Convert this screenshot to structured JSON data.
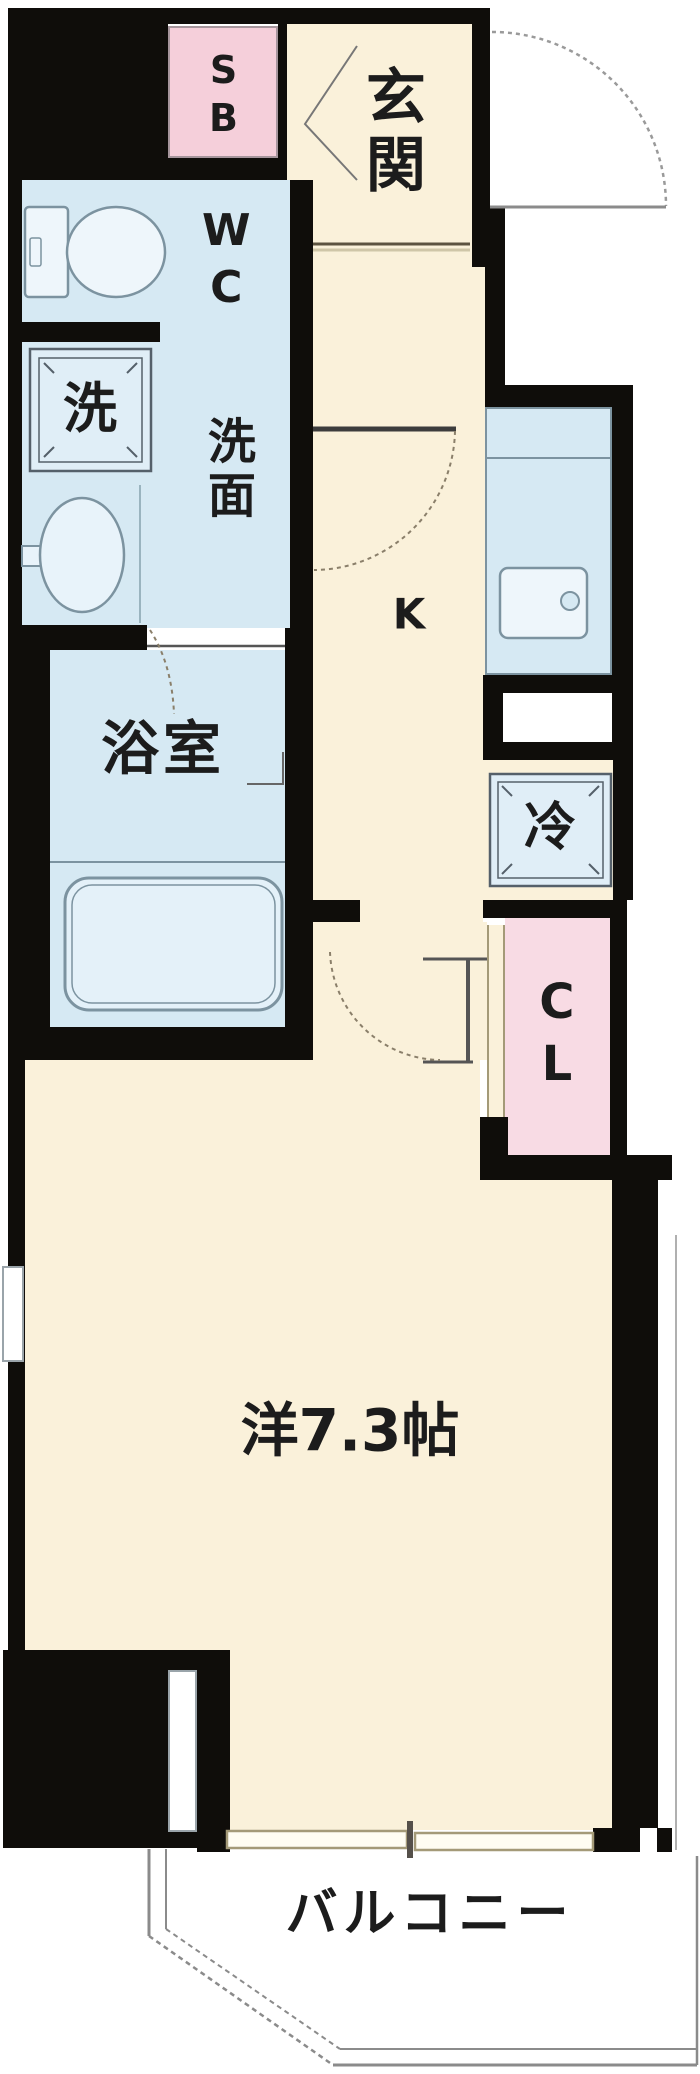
{
  "title": "apartment-floor-plan",
  "unit_layout": "1K",
  "colors": {
    "wall": "#0f0d0a",
    "floor_cream": "#faf1da",
    "wet_blue": "#d6e9f3",
    "fixture_fill": "#e6f1f9",
    "shoebox_pink": "#f5cfda",
    "closet_pink": "#f8dbe4",
    "outline_grey": "#8b8b8b",
    "door_tan": "#a49a78"
  },
  "labels": {
    "shoe_box": "SB",
    "entrance": "玄関",
    "toilet": "WC",
    "washer": "洗",
    "washroom": "洗面",
    "bathroom": "浴室",
    "kitchen": "K",
    "refrigerator": "冷",
    "closet": "CL",
    "main_room": "洋7.3帖",
    "balcony": "バルコニー"
  },
  "main_room_size_tatami": "7.3"
}
